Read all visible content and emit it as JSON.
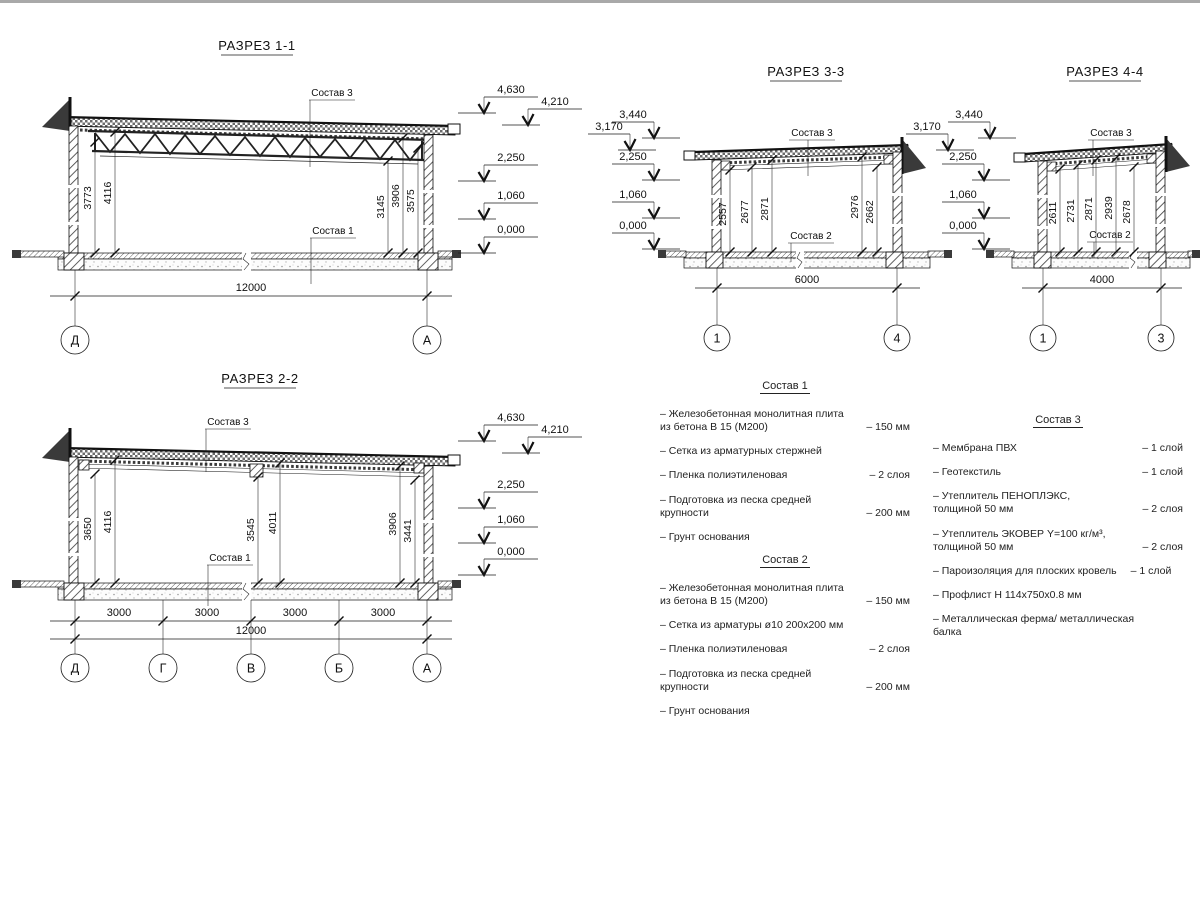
{
  "drawing": {
    "top_border_color": "#a9a9a9",
    "line_color": "#1a1a1a",
    "hatch_color": "#444444",
    "roof_fill": "#666666",
    "dark_fill": "#3a3a3a"
  },
  "sections": {
    "s1": {
      "title": "РАЗРЕЗ 1-1",
      "roof_label": "Состав 3",
      "floor_label": "Состав 1",
      "dims": [
        "3773",
        "4116",
        "3145",
        "3906",
        "3575"
      ],
      "elevations": [
        "4,630",
        "4,210",
        "2,250",
        "1,060",
        "0,000"
      ],
      "width_total": "12000",
      "axes": [
        "Д",
        "А"
      ]
    },
    "s2": {
      "title": "РАЗРЕЗ 2-2",
      "roof_label": "Состав 3",
      "floor_label": "Состав 1",
      "dims": [
        "3650",
        "4116",
        "3545",
        "4011",
        "3906",
        "3441"
      ],
      "elevations": [
        "4,630",
        "4,210",
        "2,250",
        "1,060",
        "0,000"
      ],
      "spans": [
        "3000",
        "3000",
        "3000",
        "3000"
      ],
      "width_total": "12000",
      "axes": [
        "Д",
        "Г",
        "В",
        "Б",
        "А"
      ]
    },
    "s3": {
      "title": "РАЗРЕЗ 3-3",
      "roof_label": "Состав 3",
      "floor_label": "Состав 2",
      "dims": [
        "2557",
        "2677",
        "2871",
        "2976",
        "2662"
      ],
      "elevations": [
        "3,170",
        "3,440",
        "2,250",
        "1,060",
        "0,000"
      ],
      "width_total": "6000",
      "axes": [
        "1",
        "4"
      ]
    },
    "s4": {
      "title": "РАЗРЕЗ 4-4",
      "roof_label": "Состав 3",
      "floor_label": "Состав 2",
      "dims": [
        "2611",
        "2731",
        "2871",
        "2939",
        "2678"
      ],
      "elevations": [
        "3,170",
        "3,440",
        "2,250",
        "1,060",
        "0,000"
      ],
      "width_total": "4000",
      "axes": [
        "1",
        "3"
      ]
    }
  },
  "compositions": {
    "c1": {
      "title": "Состав 1",
      "items": [
        {
          "text": "– Железобетонная  монолитная плита\nиз бетона В 15 (М200)",
          "value": "– 150 мм"
        },
        {
          "text": "– Сетка из арматурных стержней",
          "value": ""
        },
        {
          "text": "– Пленка полиэтиленовая",
          "value": "– 2 слоя"
        },
        {
          "text": "– Подготовка из песка средней\nкрупности",
          "value": "– 200 мм"
        },
        {
          "text": "– Грунт основания",
          "value": ""
        }
      ]
    },
    "c2": {
      "title": "Состав 2",
      "items": [
        {
          "text": "– Железобетонная  монолитная плита\nиз бетона В 15 (М200)",
          "value": "– 150 мм"
        },
        {
          "text": "– Сетка из арматуры ø10 200х200 мм",
          "value": ""
        },
        {
          "text": "– Пленка полиэтиленовая",
          "value": "– 2 слоя"
        },
        {
          "text": "– Подготовка из песка средней\nкрупности",
          "value": "– 200 мм"
        },
        {
          "text": "– Грунт основания",
          "value": ""
        }
      ]
    },
    "c3": {
      "title": "Состав 3",
      "items": [
        {
          "text": "– Мембрана ПВХ",
          "value": "– 1 слой"
        },
        {
          "text": "– Геотекстиль",
          "value": "– 1 слой"
        },
        {
          "text": "– Утеплитель ПЕНОПЛЭКС,\nтолщиной 50 мм",
          "value": "– 2 слоя"
        },
        {
          "text": "– Утеплитель ЭКОВЕР Y=100 кг/м³,\nтолщиной 50 мм",
          "value": "– 2 слоя"
        },
        {
          "text": "– Пароизоляция для плоских кровель",
          "value": "– 1 слой"
        },
        {
          "text": "– Профлист Н 114х750х0.8 мм",
          "value": ""
        },
        {
          "text": "– Металлическая ферма/ металлическая балка",
          "value": ""
        }
      ]
    }
  }
}
